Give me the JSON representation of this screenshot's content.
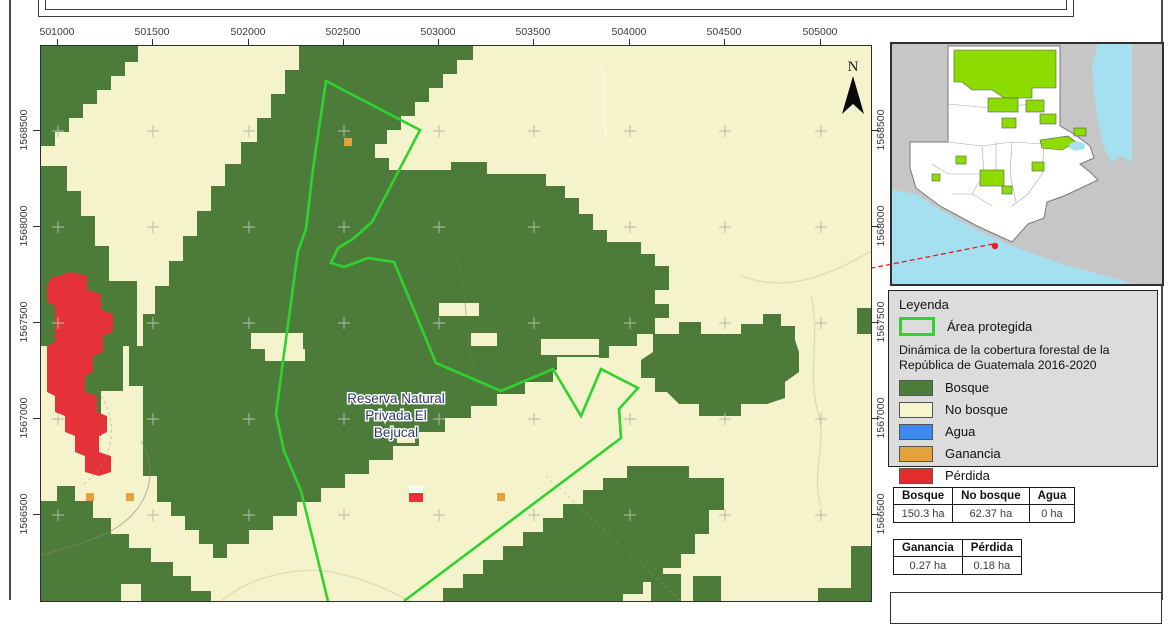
{
  "map": {
    "axis_top": [
      "501000",
      "501500",
      "502000",
      "502500",
      "503000",
      "503500",
      "504000",
      "504500",
      "505000"
    ],
    "axis_left": [
      "1568500",
      "1568000",
      "1567500",
      "1567000",
      "1566500"
    ],
    "axis_right": [
      "1568500",
      "1568000",
      "1567500",
      "1567000",
      "1566500"
    ],
    "north_label": "N",
    "area_label_line1": "Reserva Natural",
    "area_label_line2": "Privada El",
    "area_label_line3": "Bejucal"
  },
  "legend": {
    "title": "Leyenda",
    "protected_area_label": "Área protegida",
    "dataset_title_line1": "Dinámica de la cobertura forestal de la",
    "dataset_title_line2": "República de Guatemala 2016-2020",
    "items": [
      {
        "label": "Bosque",
        "color": "#4d7c3a"
      },
      {
        "label": "No bosque",
        "color": "#f7f5ce"
      },
      {
        "label": "Agua",
        "color": "#3d8af2"
      },
      {
        "label": "Ganancia",
        "color": "#e2a33d"
      },
      {
        "label": "Pérdida",
        "color": "#e32d2d"
      }
    ]
  },
  "tables": {
    "coverage": {
      "headers": [
        "Bosque",
        "No bosque",
        "Agua"
      ],
      "values": [
        "150.3 ha",
        "62.37 ha",
        "0 ha"
      ]
    },
    "change": {
      "headers": [
        "Ganancia",
        "Pérdida"
      ],
      "values": [
        "0.27 ha",
        "0.18 ha"
      ]
    }
  },
  "colors": {
    "forest_green": "#4d7c3a",
    "no_forest_pale": "#f5f3cb",
    "water_blue": "#3d8af2",
    "gain_orange": "#e2a33d",
    "loss_red": "#e53238",
    "protected_outline_green": "#2fd32f",
    "inset_protected_green": "#8ddc00",
    "inset_water_cyan": "#a5e0f0",
    "legend_bg": "#dcdcdc",
    "leader_line_red": "#e02020"
  }
}
